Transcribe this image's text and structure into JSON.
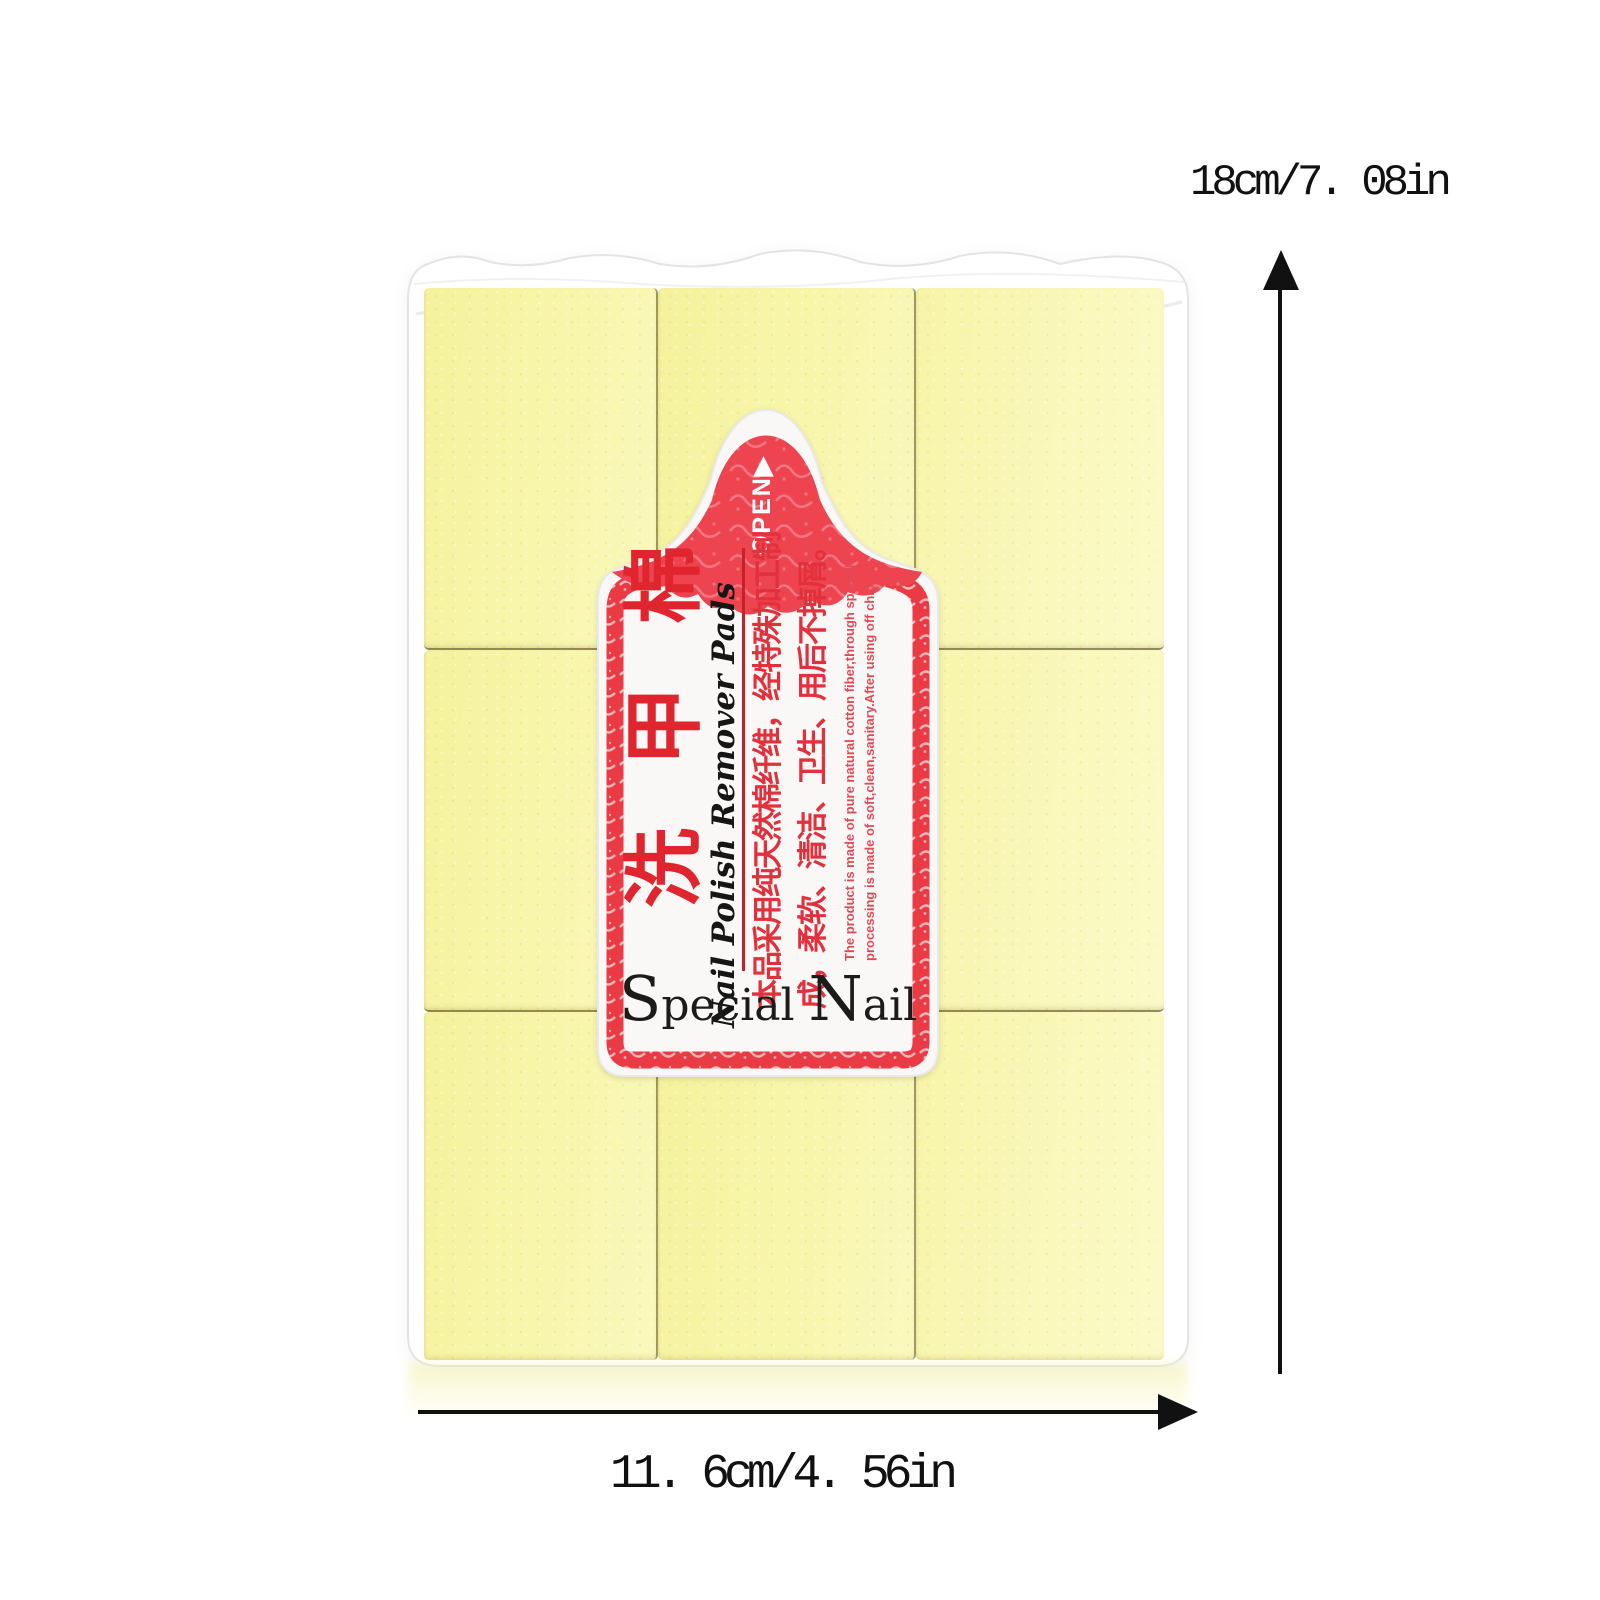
{
  "package": {
    "bag_color": "#ffffff",
    "pad_color": "#f7f4a6",
    "rows": 3,
    "cols": 3
  },
  "label": {
    "red": "#ea3b45",
    "open_text": "OPEN▶",
    "title_cn": "洗甲棉",
    "title_en": "Nail Polish Remover Pads",
    "desc_cn_line1": "本品采用纯天然棉纤维，经特殊加工制",
    "desc_cn_line2": "成，柔软、清洁、卫生、用后不掉屑。",
    "desc_en_line1": "The product is made of pure natural cotton fiber,through special",
    "desc_en_line2": "processing is made of soft,clean,sanitary.After using off chip.",
    "brand": "Special Nail",
    "brand_parts": [
      "S",
      "pecial ",
      "N",
      "ail"
    ]
  },
  "dimensions": {
    "height_text": "18cm/7. 08in",
    "width_text": "11. 6cm/4. 56in"
  }
}
